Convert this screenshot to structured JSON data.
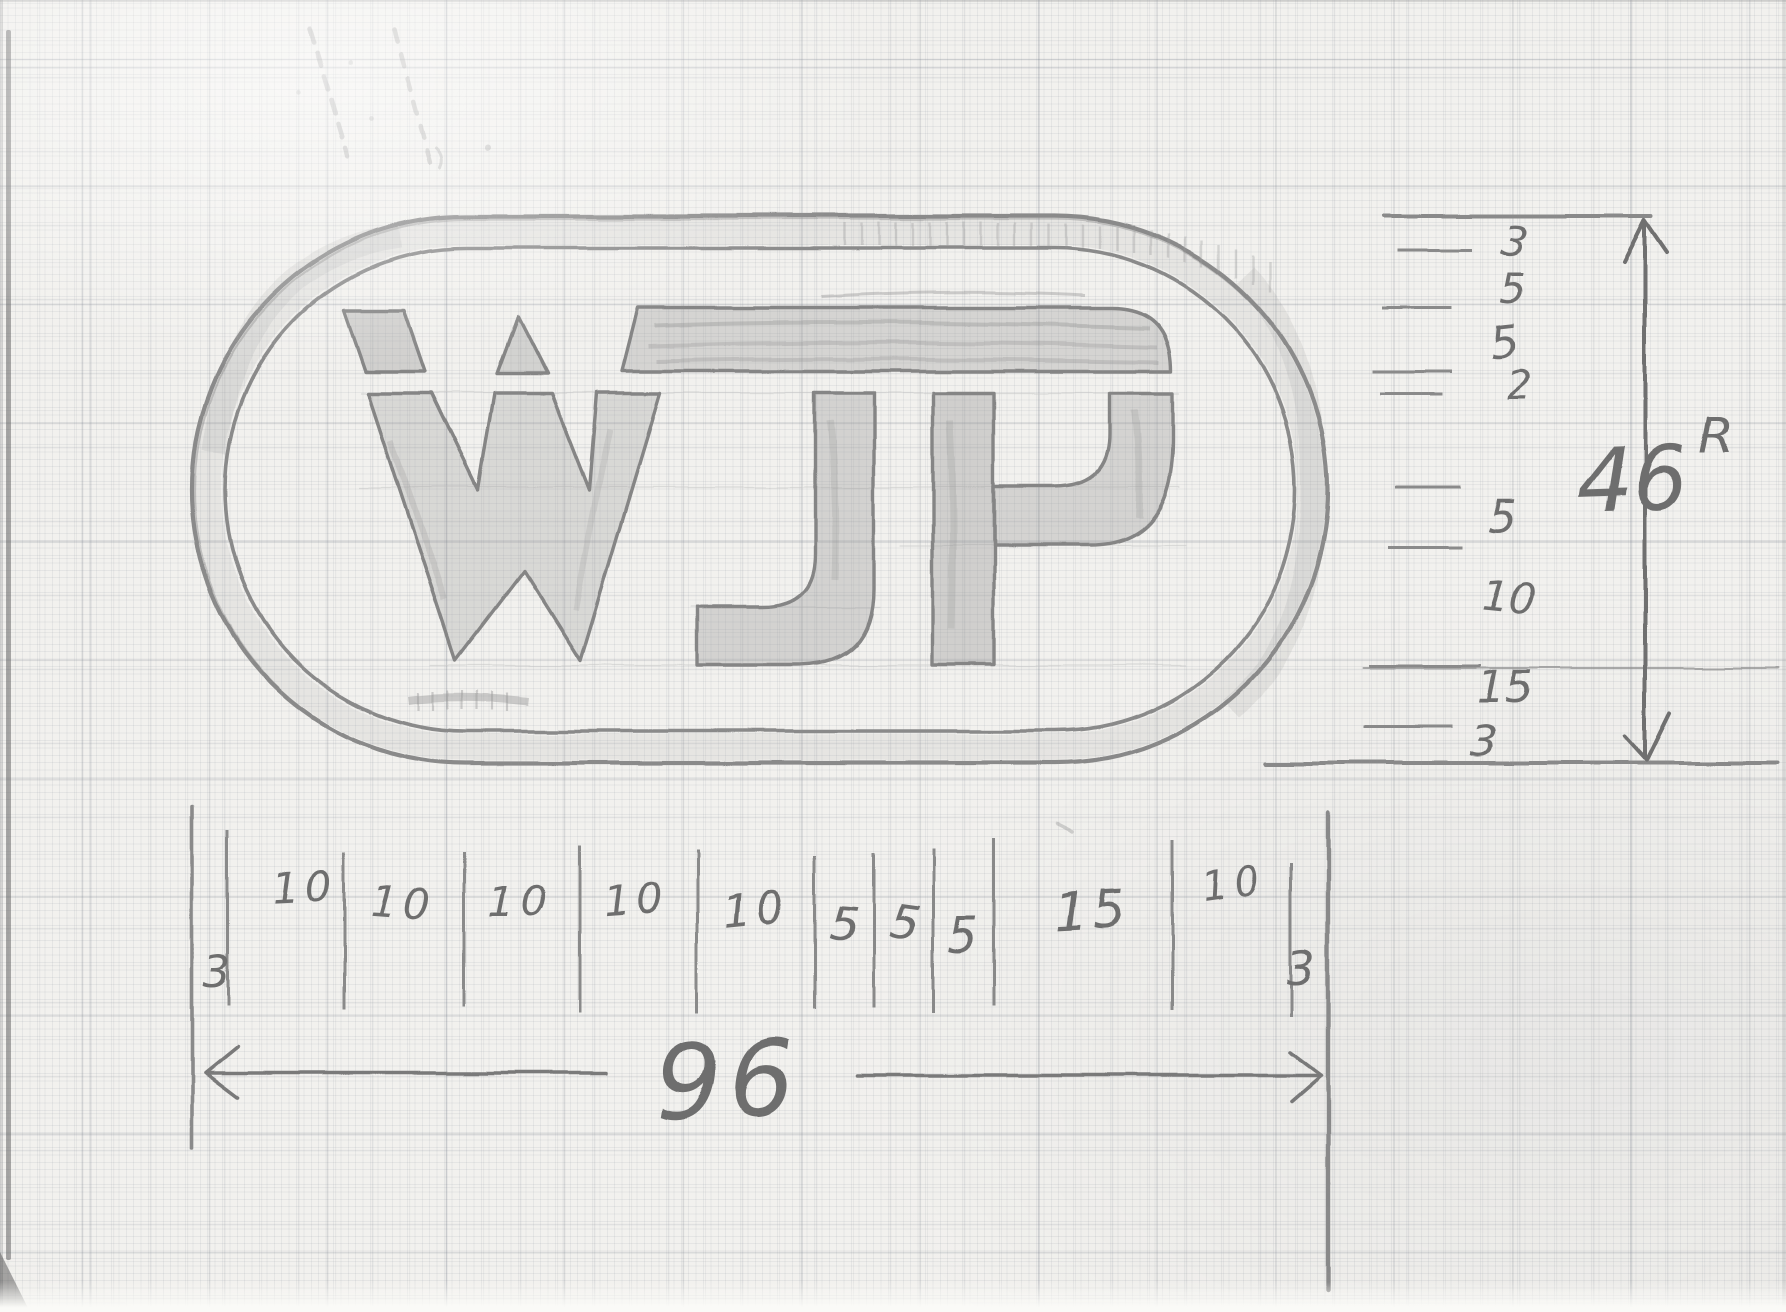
{
  "logo": {
    "text": "WJP"
  },
  "height_dimension": {
    "total": "46",
    "total_suffix": "R",
    "segment_labels": [
      "3",
      "5",
      "5",
      "2",
      "5",
      "10",
      "15",
      "3"
    ]
  },
  "width_dimension": {
    "total": "96",
    "segment_labels": [
      "3",
      "10",
      "10",
      "10",
      "10",
      "10",
      "5",
      "5",
      "5",
      "15",
      "10",
      "3"
    ]
  },
  "colors": {
    "pencil": "#8a8a8a",
    "pencil_dark": "#6e6e6e",
    "paper": "#f2f1ee",
    "grid_line": "#c7cad0"
  }
}
